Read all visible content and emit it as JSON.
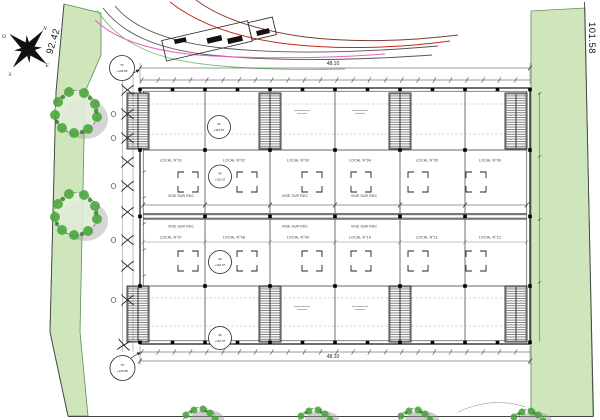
{
  "site": {
    "left_boundary_length": "92.42",
    "right_boundary_length": "101.58"
  },
  "compass": {
    "north": "N",
    "east": "E",
    "south": "S",
    "west": "O"
  },
  "level_markers": {
    "tf": {
      "abbr": "TF",
      "value": "+106.85"
    },
    "sf": {
      "abbr": "SF",
      "value": "+110.57"
    }
  },
  "dimensions": {
    "total_width_top": "48.10",
    "total_width_bottom": "48.10"
  },
  "plan": {
    "locals_row1": [
      "LOCAL N°01",
      "LOCAL N°02",
      "LOCAL N°03",
      "LOCAL N°04",
      "LOCAL N°05",
      "LOCAL N°06"
    ],
    "locals_row2": [
      "LOCAL N°07",
      "LOCAL N°08",
      "LOCAL N°09",
      "LOCAL N°10",
      "LOCAL N°11",
      "LOCAL N°12"
    ],
    "void_label": "VIDE SUR RDC"
  },
  "colors": {
    "landscape_green": "#cfe6bd",
    "landscape_edge": "#5c8f55",
    "tree_green": "#4aa53c",
    "shadow_gray": "#9a9a9a",
    "path_green": "#7cc47c",
    "path_gray": "#555555",
    "path_magenta": "#e45fc8",
    "path_red": "#c3271a",
    "path_brown": "#7e3b2a"
  }
}
